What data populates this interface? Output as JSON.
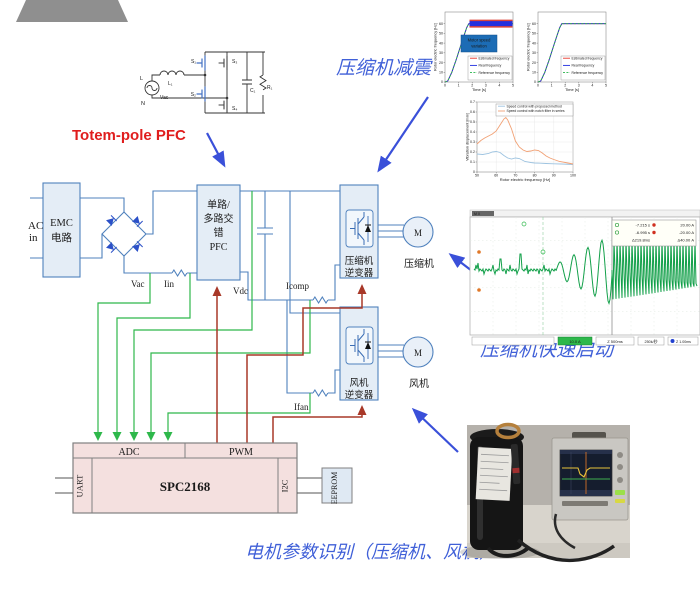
{
  "labels": {
    "totem": "Totem-pole PFC",
    "damping": "压缩机减震",
    "fast_start": "压缩机快速启动",
    "param_id": "电机参数识别（压缩机、风机）"
  },
  "blocks": {
    "ac_in": [
      "AC",
      "in"
    ],
    "emc": [
      "EMC",
      "电路"
    ],
    "pfc": [
      "单路/",
      "多路交",
      "错",
      "PFC"
    ],
    "comp_inverter": [
      "压缩机",
      "逆变器"
    ],
    "fan_inverter": [
      "风机",
      "逆变器"
    ],
    "comp_motor": {
      "symbol": "M",
      "label": "压缩机"
    },
    "fan_motor": {
      "symbol": "M",
      "label": "风机"
    }
  },
  "signals": {
    "vac": "Vac",
    "iin": "Iin",
    "vdc": "Vdc",
    "icomp": "Icomp",
    "ifan": "Ifan"
  },
  "mcu": {
    "adc": "ADC",
    "pwm": "PWM",
    "chip": "SPC2168",
    "uart": "UART",
    "i2c": "I2C",
    "eeprom": "EEPROM"
  },
  "schematic": {
    "l": "L",
    "n": "N",
    "vsrc": "Vac",
    "l1": "L₁",
    "s1": "S₁",
    "s2": "S₂",
    "s3": "S₃",
    "s4": "S₄",
    "c1": "C₁",
    "r1": "R₁"
  },
  "scope": {
    "header": "M X",
    "meas": [
      [
        "-7.215 s",
        "20.00 A"
      ],
      [
        "-6.995 s",
        "-20.00 A"
      ],
      [
        "Δ219.8ms",
        "Δ40.00 A"
      ]
    ],
    "bottom": [
      "10.0 A",
      "Z 500ms",
      "250k/秒",
      "Z 1.00ms"
    ]
  },
  "chart_data": [
    {
      "type": "line",
      "title": "",
      "xlabel": "Time [s]",
      "ylabel": "Rotor electric frequency [Hz]",
      "xlim": [
        0,
        5
      ],
      "ylim": [
        0,
        72
      ],
      "xticks": [
        0,
        1,
        2,
        3,
        4,
        5
      ],
      "yticks": [
        0,
        10,
        20,
        30,
        40,
        50,
        60
      ],
      "grid": false,
      "legend_position": "bottom-right",
      "annotation": [
        "Motor speed",
        "variation"
      ],
      "band": {
        "center": 60,
        "halfwidth": 5,
        "from": 1.8
      },
      "series": [
        {
          "name": "Estimated frequency",
          "color": "#e8372c",
          "x": [
            0,
            0.2,
            0.5,
            0.8,
            1.1,
            1.4,
            1.6,
            1.75,
            2,
            2.5,
            3,
            3.5,
            4,
            4.5,
            5
          ],
          "y": [
            0,
            1,
            10,
            22,
            35,
            48,
            56,
            60,
            60,
            60,
            60,
            60,
            60,
            60,
            60
          ]
        },
        {
          "name": "Real frequency",
          "color": "#1f2de0",
          "x": [
            0,
            0.2,
            0.5,
            0.8,
            1.1,
            1.4,
            1.6,
            1.75,
            2,
            2.5,
            3,
            3.5,
            4,
            4.5,
            5
          ],
          "y": [
            0,
            1,
            10,
            22,
            35,
            48,
            56,
            60,
            60,
            60,
            60,
            60,
            60,
            60,
            60
          ]
        },
        {
          "name": "Reference frequency",
          "color": "#28b44b",
          "dash": true,
          "x": [
            0,
            0.2,
            0.5,
            0.8,
            1.1,
            1.4,
            1.6,
            1.75,
            2,
            2.5,
            3,
            3.5,
            4,
            4.5,
            5
          ],
          "y": [
            0,
            1,
            10,
            22,
            35,
            48,
            56,
            60,
            60,
            60,
            60,
            60,
            60,
            60,
            60
          ]
        }
      ]
    },
    {
      "type": "line",
      "title": "",
      "xlabel": "Time [s]",
      "ylabel": "Rotor electric frequency [Hz]",
      "xlim": [
        0,
        5
      ],
      "ylim": [
        0,
        72
      ],
      "xticks": [
        0,
        1,
        2,
        3,
        4,
        5
      ],
      "yticks": [
        0,
        10,
        20,
        30,
        40,
        50,
        60
      ],
      "grid": false,
      "legend_position": "bottom-right",
      "series": [
        {
          "name": "Estimated frequency",
          "color": "#e8372c",
          "x": [
            0,
            0.2,
            0.5,
            0.8,
            1.1,
            1.4,
            1.6,
            1.75,
            2,
            2.5,
            3,
            3.5,
            4,
            4.5,
            5
          ],
          "y": [
            0,
            1,
            10,
            22,
            35,
            48,
            56,
            60,
            60,
            60,
            60,
            60,
            60,
            60,
            60
          ]
        },
        {
          "name": "Real frequency",
          "color": "#1f2de0",
          "x": [
            0,
            0.2,
            0.5,
            0.8,
            1.1,
            1.4,
            1.6,
            1.75,
            2,
            2.5,
            3,
            3.5,
            4,
            4.5,
            5
          ],
          "y": [
            0,
            1,
            10,
            22,
            35,
            48,
            56,
            60,
            60,
            60,
            60,
            60,
            60,
            60,
            60
          ]
        },
        {
          "name": "Reference frequency",
          "color": "#28b44b",
          "dash": true,
          "x": [
            0,
            0.2,
            0.5,
            0.8,
            1.1,
            1.4,
            1.6,
            1.75,
            2,
            2.5,
            3,
            3.5,
            4,
            4.5,
            5
          ],
          "y": [
            0,
            1,
            10,
            22,
            35,
            48,
            56,
            60,
            60,
            60,
            60,
            60,
            60,
            60,
            60
          ]
        }
      ]
    },
    {
      "type": "line",
      "title": "",
      "xlabel": "Rotor electric frequency [Hz]",
      "ylabel": "Vibration displacement [mm]",
      "xlim": [
        50,
        100
      ],
      "ylim": [
        0,
        0.7
      ],
      "xticks": [
        50,
        60,
        70,
        80,
        90,
        100
      ],
      "yticks": [
        0,
        0.1,
        0.2,
        0.3,
        0.4,
        0.5,
        0.6,
        0.7
      ],
      "grid": true,
      "legend_position": "top",
      "series": [
        {
          "name": "Speed control with proposed method",
          "color": "#9dc3e0",
          "x": [
            50,
            53,
            56,
            58,
            60,
            62,
            64,
            66,
            68,
            70,
            72,
            75,
            78,
            80,
            83,
            86,
            90,
            94,
            100
          ],
          "y": [
            0.18,
            0.175,
            0.185,
            0.2,
            0.205,
            0.195,
            0.165,
            0.14,
            0.13,
            0.14,
            0.135,
            0.105,
            0.095,
            0.09,
            0.088,
            0.085,
            0.082,
            0.08,
            0.075
          ]
        },
        {
          "name": "Speed control with notch filter in series",
          "color": "#f1a175",
          "x": [
            50,
            52,
            54,
            56,
            58,
            60,
            62,
            64,
            65,
            66,
            68,
            70,
            72,
            74,
            76,
            78,
            80,
            82,
            84,
            86,
            88,
            90,
            93,
            96,
            100
          ],
          "y": [
            0.28,
            0.315,
            0.34,
            0.36,
            0.38,
            0.41,
            0.47,
            0.53,
            0.545,
            0.52,
            0.43,
            0.31,
            0.25,
            0.22,
            0.205,
            0.21,
            0.22,
            0.215,
            0.19,
            0.16,
            0.14,
            0.125,
            0.105,
            0.095,
            0.08
          ]
        }
      ]
    }
  ]
}
